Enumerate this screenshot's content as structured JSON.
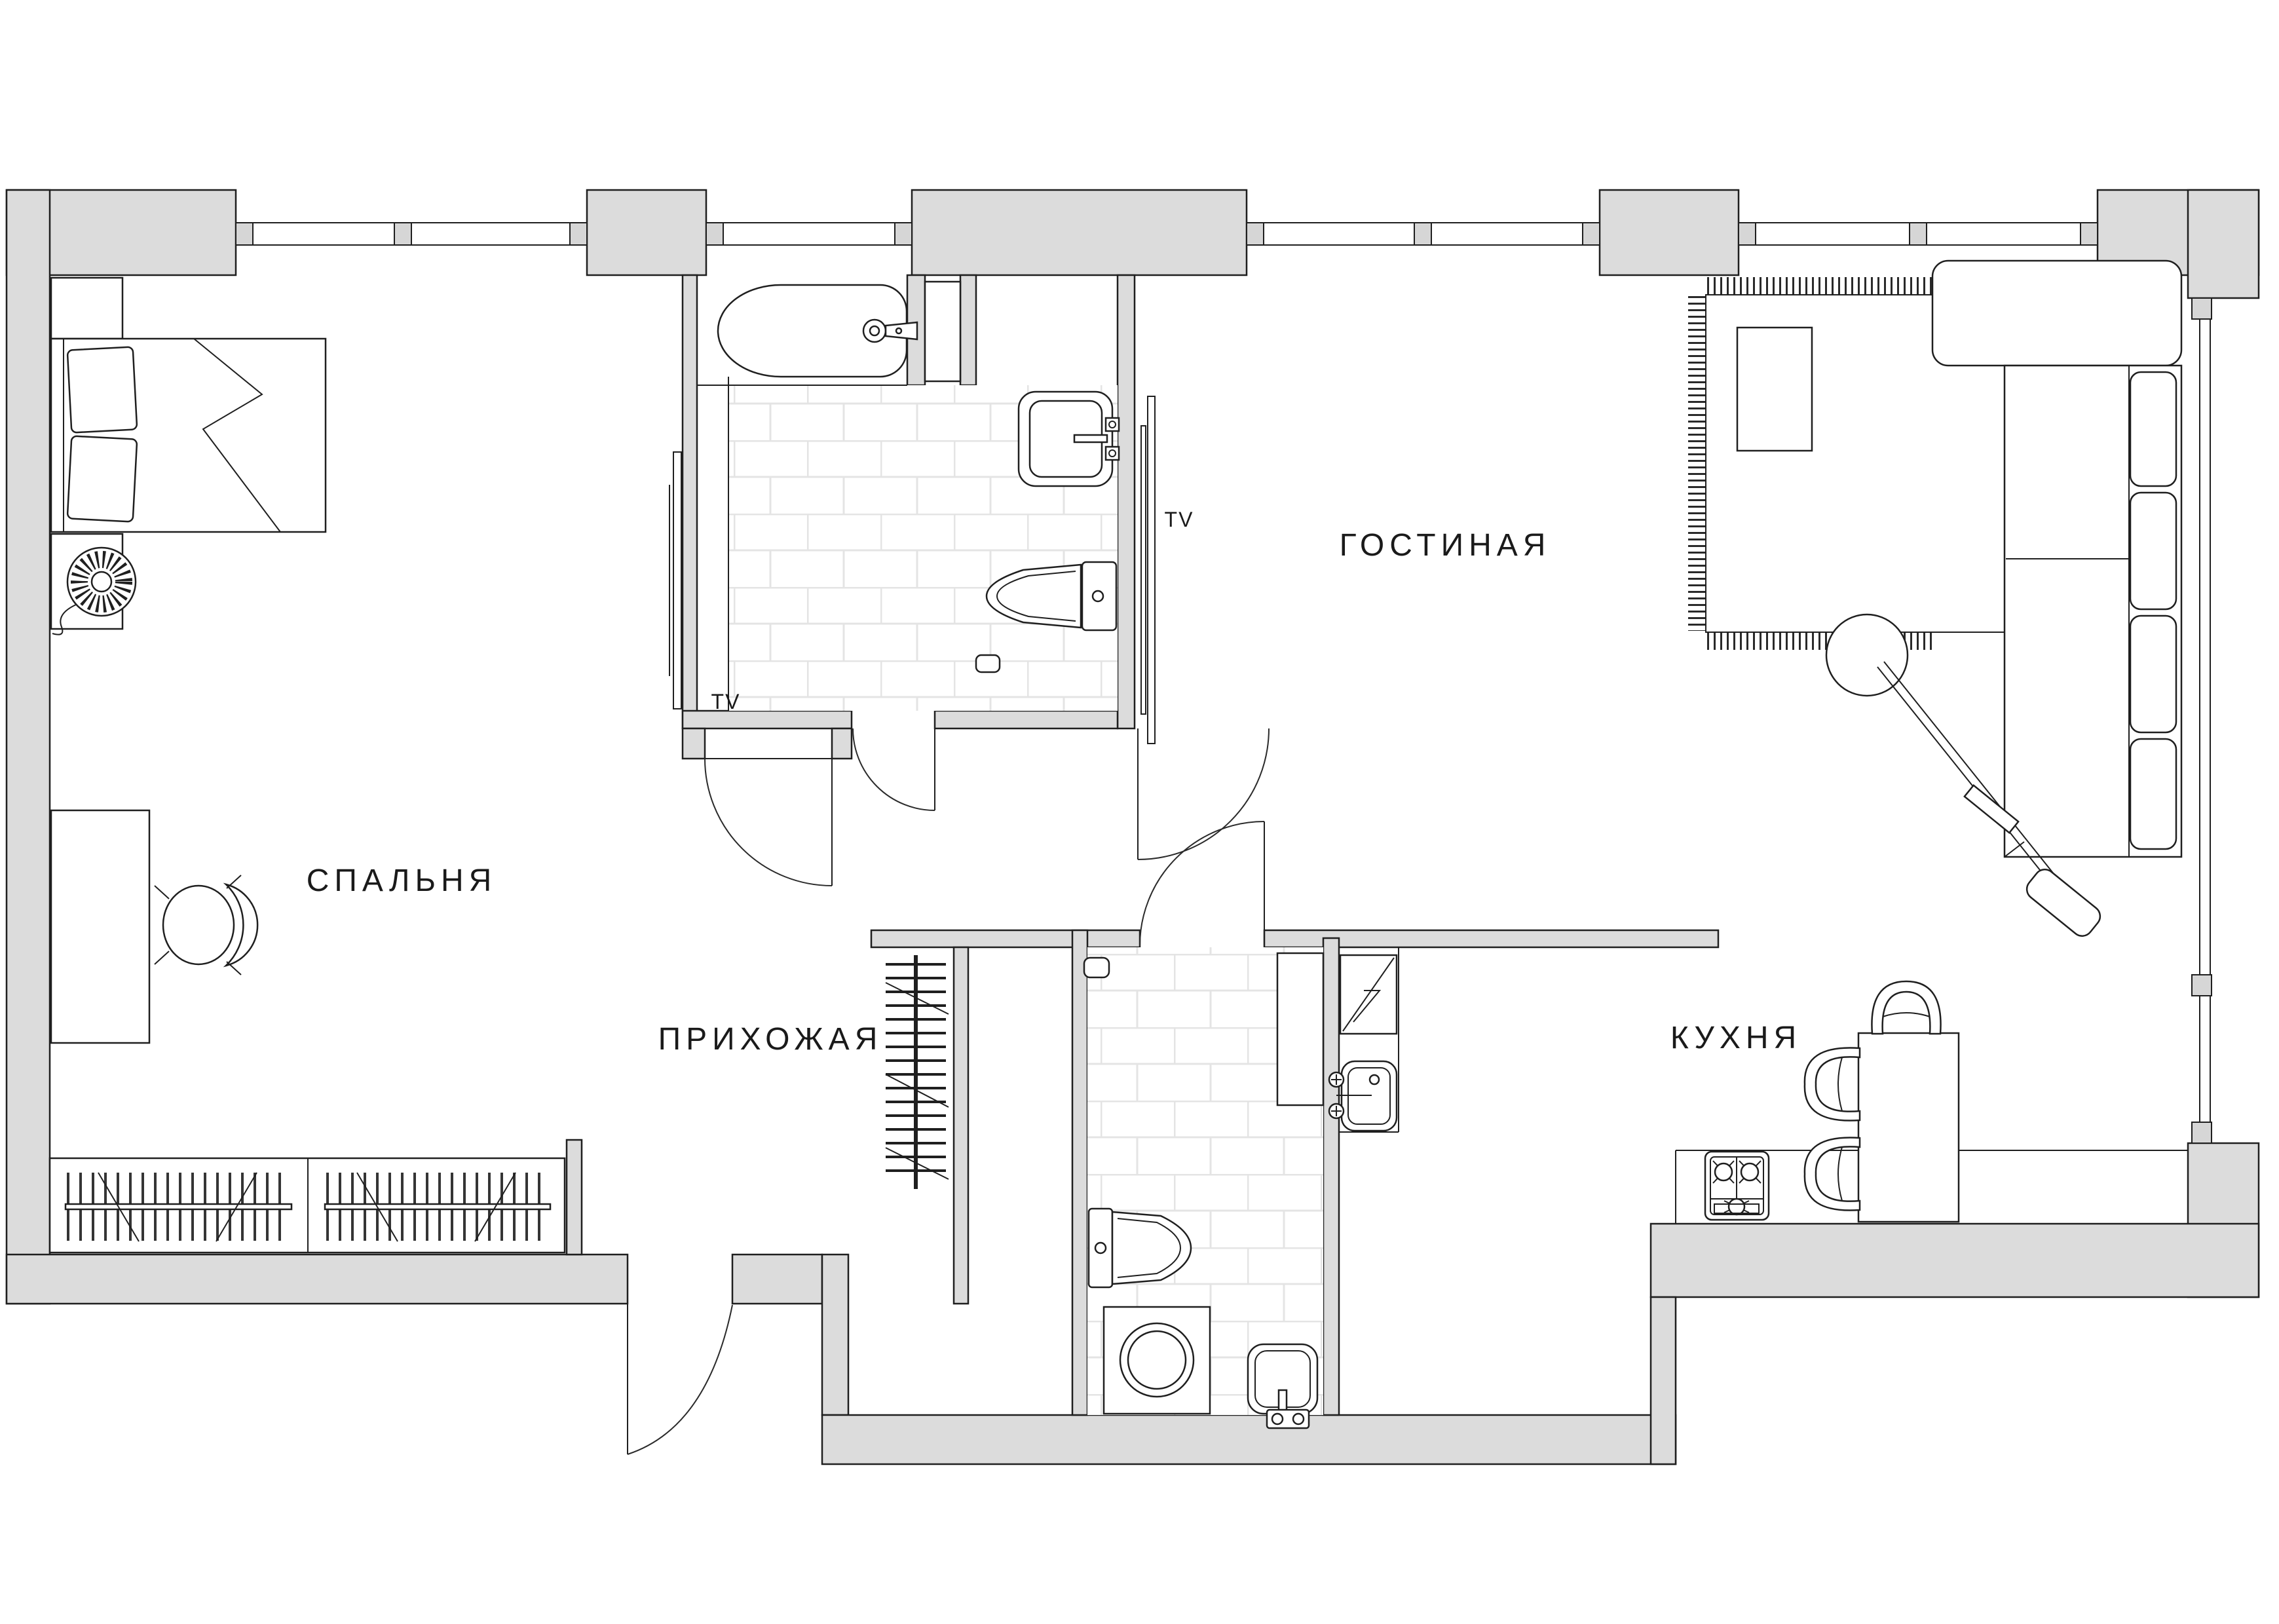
{
  "plan": {
    "type": "apartment-floor-plan",
    "language": "ru",
    "rooms": {
      "bedroom": {
        "label": "СПАЛЬНЯ"
      },
      "hallway": {
        "label": "ПРИХОЖАЯ"
      },
      "living": {
        "label": "ГОСТИНАЯ"
      },
      "kitchen": {
        "label": "КУХНЯ"
      }
    },
    "annotations": {
      "bedroom_tv": "TV",
      "living_tv": "TV"
    },
    "icons": [
      "bed-icon",
      "pillow-icon",
      "nightstand-icon",
      "lamp-icon",
      "desk-icon",
      "chair-icon",
      "wardrobe-icon",
      "hanger-rail-icon",
      "coat-rack-icon",
      "bathtub-icon",
      "faucet-icon",
      "sink-icon",
      "toilet-icon",
      "floor-drain-icon",
      "washing-machine-icon",
      "cabinet-icon",
      "fridge-icon",
      "kitchen-sink-icon",
      "stove-icon",
      "dining-table-icon",
      "dining-chair-icon",
      "sofa-icon",
      "sofa-cushion-icon",
      "rug-icon",
      "coffee-table-icon",
      "floor-lamp-icon",
      "tv-panel-icon",
      "window-icon",
      "door-swing-icon"
    ],
    "colors": {
      "background": "#ffffff",
      "wall_fill": "#dcdcdc",
      "outline": "#1f1f1f",
      "tile_line": "#e4e4e4"
    }
  }
}
